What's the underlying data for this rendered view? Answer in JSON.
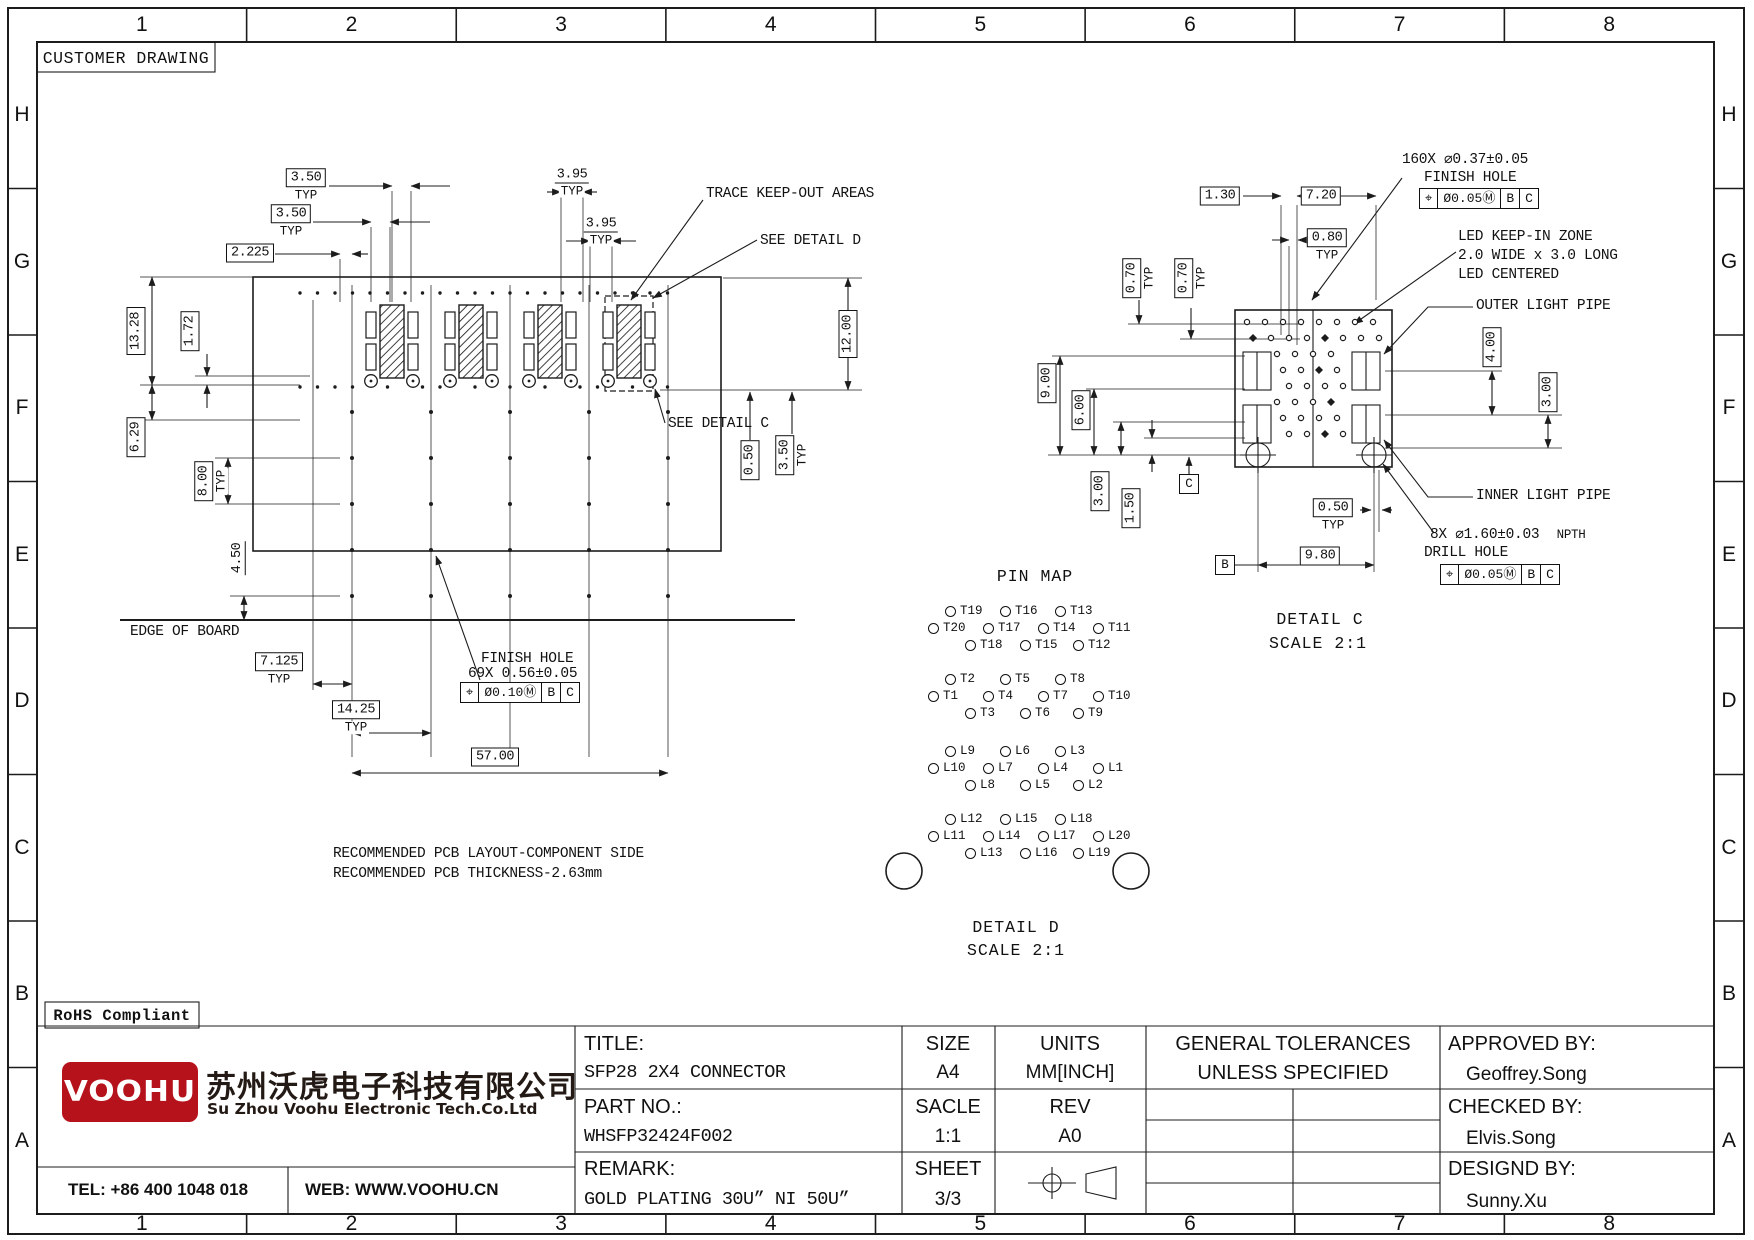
{
  "sheet": {
    "header_note": "CUSTOMER DRAWING",
    "rohs": "RoHS Compliant"
  },
  "misc": {
    "typ_label": "TYP"
  },
  "rulers": {
    "columns": [
      "1",
      "2",
      "3",
      "4",
      "5",
      "6",
      "7",
      "8"
    ],
    "rows": [
      "H",
      "G",
      "F",
      "E",
      "D",
      "C",
      "B",
      "A"
    ]
  },
  "left_view": {
    "dims": [
      {
        "t": "3.50",
        "typ": true
      },
      {
        "t": "3.50",
        "typ": true
      },
      {
        "t": "2.225"
      },
      {
        "t": "3.95",
        "typ": true,
        "nb": true
      },
      {
        "t": "3.95",
        "typ": true,
        "nb": true
      },
      {
        "t": "13.28"
      },
      {
        "t": "1.72"
      },
      {
        "t": "6.29"
      },
      {
        "t": "8.00",
        "typ": true
      },
      {
        "t": "4.50",
        "nb": true
      },
      {
        "t": "12.00"
      },
      {
        "t": "0.50"
      },
      {
        "t": "3.50",
        "typ": true
      },
      {
        "t": "7.125",
        "typ": true
      },
      {
        "t": "14.25",
        "typ": true
      },
      {
        "t": "57.00"
      }
    ],
    "callouts": {
      "trace": "TRACE KEEP-OUT AREAS",
      "detail_d": "SEE DETAIL D",
      "detail_c": "SEE DETAIL C",
      "edge": "EDGE OF BOARD",
      "finish_1": "FINISH HOLE",
      "finish_2": "69X 0.56±0.05"
    },
    "fcf": [
      "⌖",
      "Ø0.10Ⓜ",
      "B",
      "C"
    ],
    "notes": [
      "RECOMMENDED PCB LAYOUT-COMPONENT SIDE",
      "RECOMMENDED PCB THICKNESS-2.63mm"
    ]
  },
  "right_view": {
    "dims": [
      {
        "t": "1.30"
      },
      {
        "t": "7.20"
      },
      {
        "t": "0.80",
        "typ": true
      },
      {
        "t": "0.70",
        "typ": true
      },
      {
        "t": "0.70",
        "typ": true
      },
      {
        "t": "9.00"
      },
      {
        "t": "6.00"
      },
      {
        "t": "3.00"
      },
      {
        "t": "1.50"
      },
      {
        "t": "0.50",
        "typ": true
      },
      {
        "t": "9.80"
      },
      {
        "t": "4.00"
      },
      {
        "t": "3.00"
      }
    ],
    "datums": [
      "C",
      "B"
    ],
    "callouts": {
      "hole160": "160X ⌀0.37±0.05",
      "finish_hole": "FINISH HOLE",
      "led1": "LED KEEP-IN ZONE",
      "led2": "2.0 WIDE x 3.0 LONG",
      "led3": "LED CENTERED",
      "outer": "OUTER LIGHT PIPE",
      "inner": "INNER LIGHT PIPE",
      "drill": "8X ⌀1.60±0.03",
      "npth": "NPTH",
      "drill2": "DRILL HOLE"
    },
    "fcf_top": [
      "⌖",
      "Ø0.05Ⓜ",
      "B",
      "C"
    ],
    "fcf_bottom": [
      "⌖",
      "Ø0.05Ⓜ",
      "B",
      "C"
    ],
    "title": "DETAIL C",
    "scale": "SCALE 2:1"
  },
  "pin_map": {
    "title": "PIN MAP",
    "groups": [
      [
        [
          "T19",
          "T16",
          "T13"
        ],
        [
          "T20",
          "T17",
          "T14",
          "T11"
        ],
        [
          "T18",
          "T15",
          "T12"
        ]
      ],
      [
        [
          "T2",
          "T5",
          "T8"
        ],
        [
          "T1",
          "T4",
          "T7",
          "T10"
        ],
        [
          "T3",
          "T6",
          "T9"
        ]
      ],
      [
        [
          "L9",
          "L6",
          "L3"
        ],
        [
          "L10",
          "L7",
          "L4",
          "L1"
        ],
        [
          "L8",
          "L5",
          "L2"
        ]
      ],
      [
        [
          "L12",
          "L15",
          "L18"
        ],
        [
          "L11",
          "L14",
          "L17",
          "L20"
        ],
        [
          "L13",
          "L16",
          "L19"
        ]
      ]
    ],
    "detail_title": "DETAIL D",
    "detail_scale": "SCALE 2:1"
  },
  "title_block": {
    "title_label": "TITLE:",
    "title_value": "SFP28 2X4 CONNECTOR",
    "part_label": "PART NO.:",
    "part_value": "WHSFP32424F002",
    "remark_label": "REMARK:",
    "remark_value": "GOLD PLATING 30U” NI 50U”",
    "size_label": "SIZE",
    "size_value": "A4",
    "scale_label": "SACLE",
    "scale_value": "1:1",
    "sheet_label": "SHEET",
    "sheet_value": "3/3",
    "units_label": "UNITS",
    "units_value": "MM[INCH]",
    "rev_label": "REV",
    "rev_value": "A0",
    "tol_header_1": "GENERAL TOLERANCES",
    "tol_header_2": "UNLESS SPECIFIED",
    "tolerances": [
      [
        "x±0.35",
        "x°±3.0°"
      ],
      [
        ".x±0.30",
        ".x°±2.0°"
      ],
      [
        ".xx±0.25",
        ".xx°±1.5°"
      ],
      [
        ".xxx±0.10",
        ".xxx°±1.0°"
      ]
    ],
    "approved_label": "APPROVED BY:",
    "approved_value": "Geoffrey.Song",
    "checked_label": "CHECKED BY:",
    "checked_value": "Elvis.Song",
    "designed_label": "DESIGND BY:",
    "designed_value": "Sunny.Xu",
    "company_cn": "苏州沃虎电子科技有限公司",
    "company_en": "Su Zhou Voohu Electronic Tech.Co.Ltd",
    "logo_text": "VOOHU",
    "brand_color": "#b5121b",
    "tel": "TEL: +86 400 1048 018",
    "web": "WEB: WWW.VOOHU.CN"
  }
}
